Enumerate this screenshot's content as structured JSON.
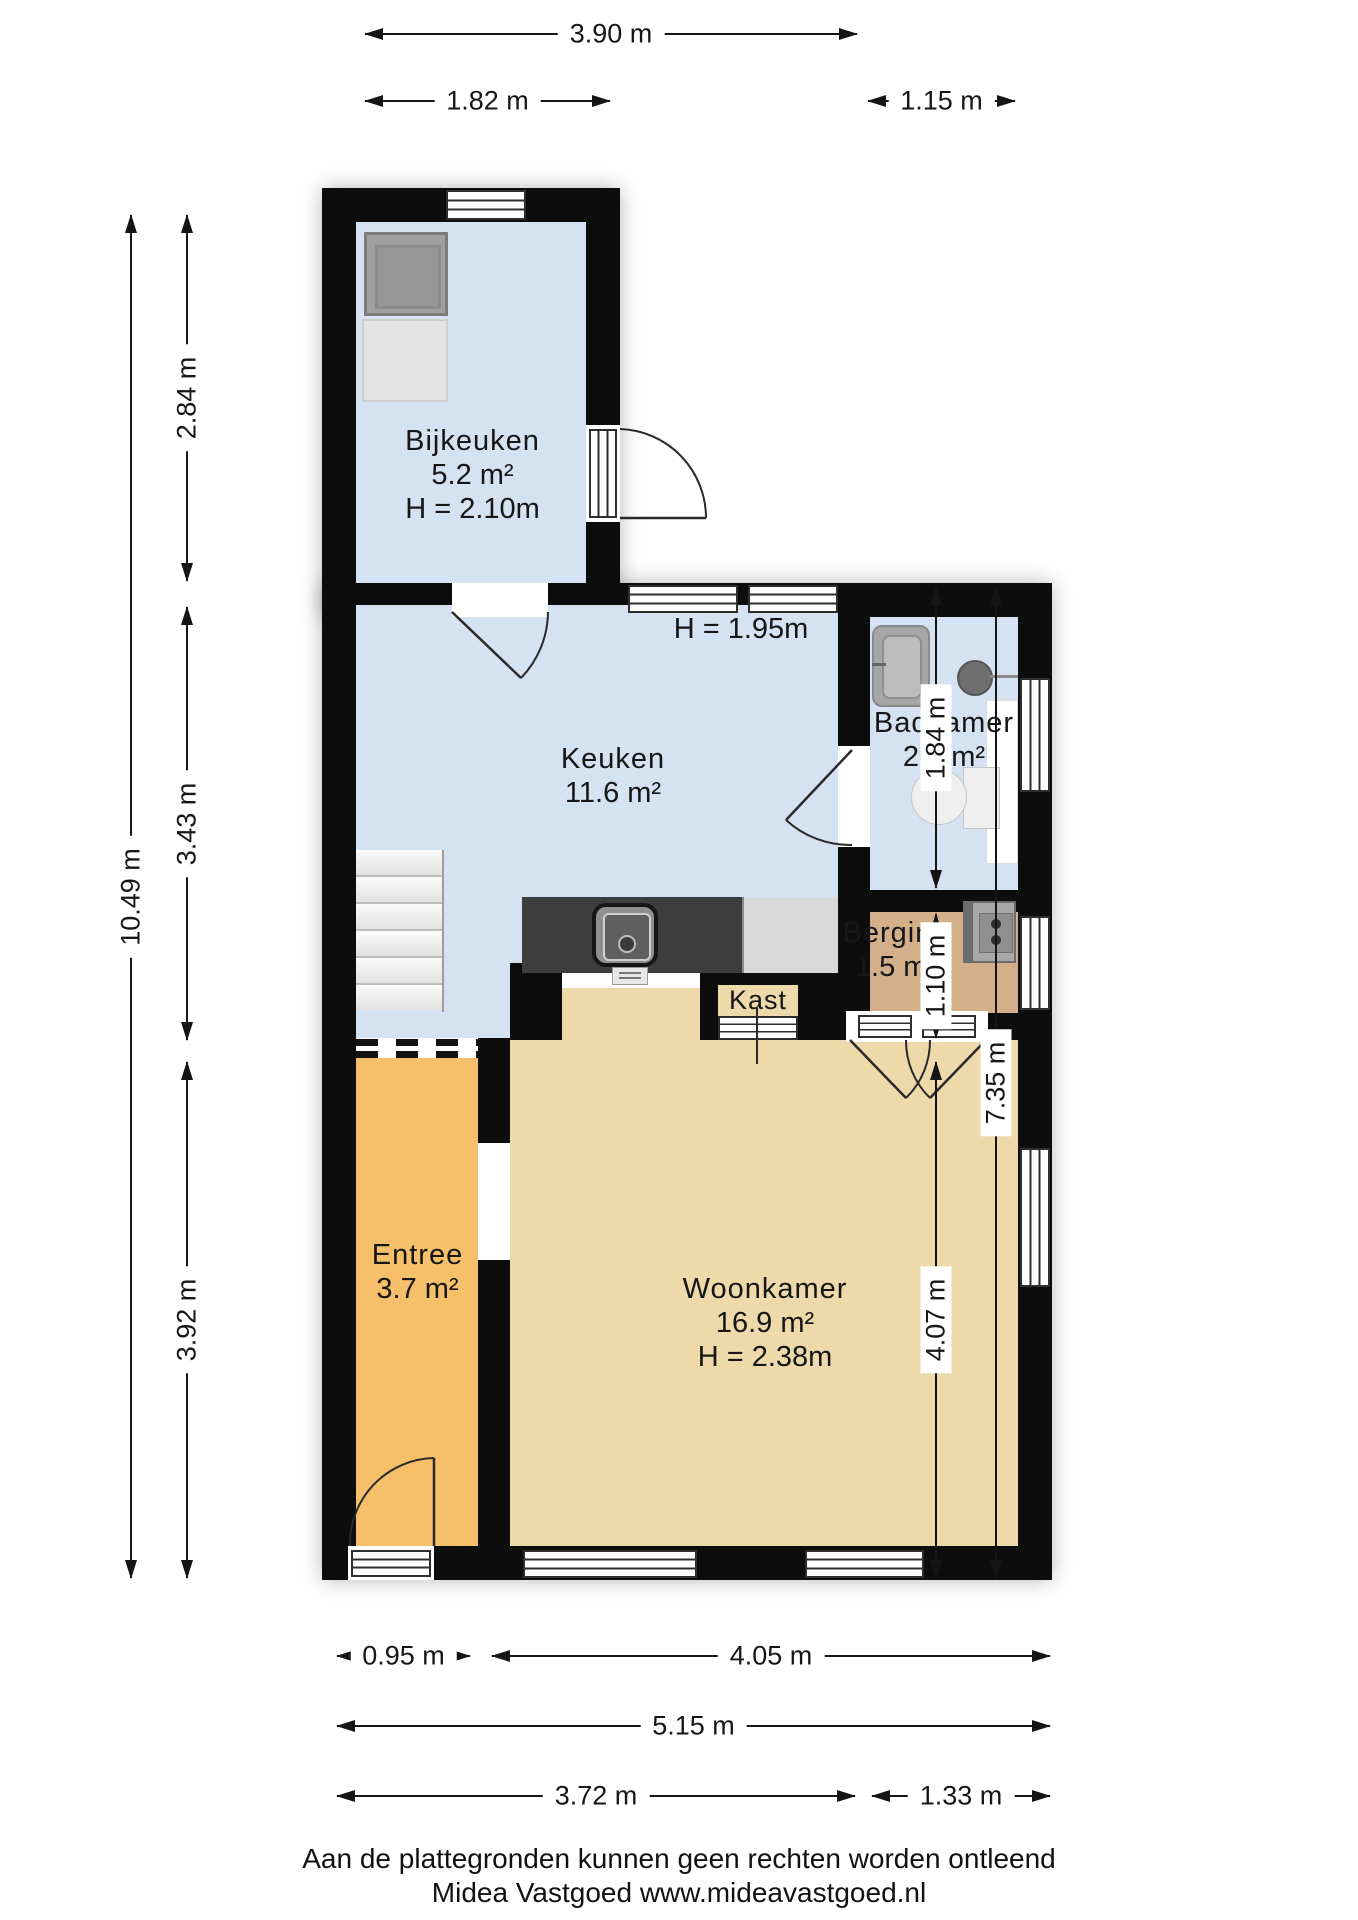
{
  "rooms": {
    "bijkeuken": {
      "name": "Bijkeuken",
      "area": "5.2 m²",
      "ceiling": "H = 2.10m"
    },
    "keuken": {
      "name": "Keuken",
      "area": "11.6 m²",
      "ceiling_note": "H = 1.95m"
    },
    "badkamer": {
      "name": "Badkamer",
      "area": "2.1 m²"
    },
    "berging": {
      "name": "Berging",
      "area": "1.5 m²"
    },
    "kast": {
      "name": "Kast"
    },
    "entree": {
      "name": "Entree",
      "area": "3.7 m²"
    },
    "woonkamer": {
      "name": "Woonkamer",
      "area": "16.9 m²",
      "ceiling": "H = 2.38m"
    }
  },
  "dimensions": {
    "top": {
      "total": "3.90 m",
      "left": "1.82 m",
      "right": "1.15 m"
    },
    "left": {
      "total": "10.49 m",
      "top": "2.84 m",
      "middle": "3.43 m",
      "bottom": "3.92 m"
    },
    "right": {
      "badkamer": "1.84 m",
      "berging": "1.10 m",
      "woonkamer": "4.07 m",
      "total": "7.35 m"
    },
    "bottom": {
      "entree": "0.95 m",
      "woonkamer": "4.05 m",
      "total": "5.15 m",
      "lower_left": "3.72 m",
      "lower_right": "1.33 m"
    }
  },
  "footer": {
    "disclaimer": "Aan de plattegronden kunnen geen rechten worden ontleend",
    "credit": "Midea Vastgoed www.mideavastgoed.nl"
  },
  "colors": {
    "wall": "#0d0d0d",
    "room_blue": "#d4e2f1",
    "room_tan": "#eed9ab",
    "room_orange": "#f6bf69",
    "room_brown": "#d3b089",
    "counter_dark": "#3d3d3d",
    "counter_light": "#d9d9d9"
  }
}
